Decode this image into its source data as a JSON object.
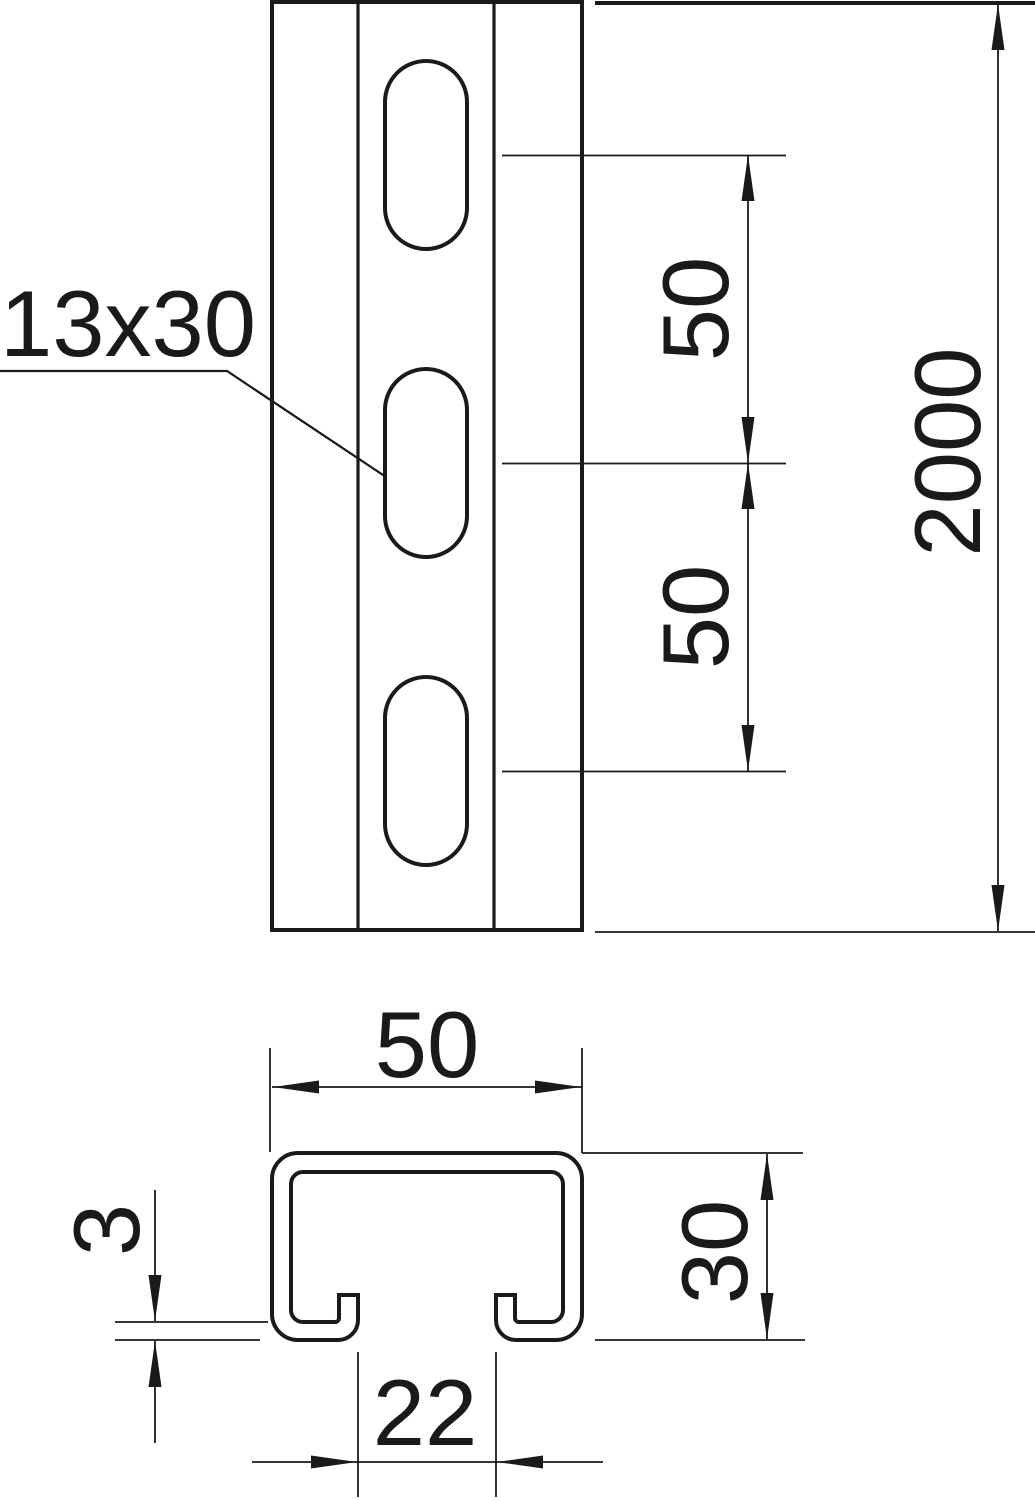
{
  "drawing_title": "slotted-profile-rail-dimension-drawing",
  "front_view": {
    "slot_label": "13x30",
    "pitch_dim_upper": "50",
    "pitch_dim_lower": "50",
    "length_dim": "2000"
  },
  "section_view": {
    "width_dim": "50",
    "thickness_dim": "3",
    "height_dim": "30",
    "opening_dim": "22"
  },
  "colors": {
    "ink": "#1a1a1a",
    "background": "#ffffff"
  }
}
